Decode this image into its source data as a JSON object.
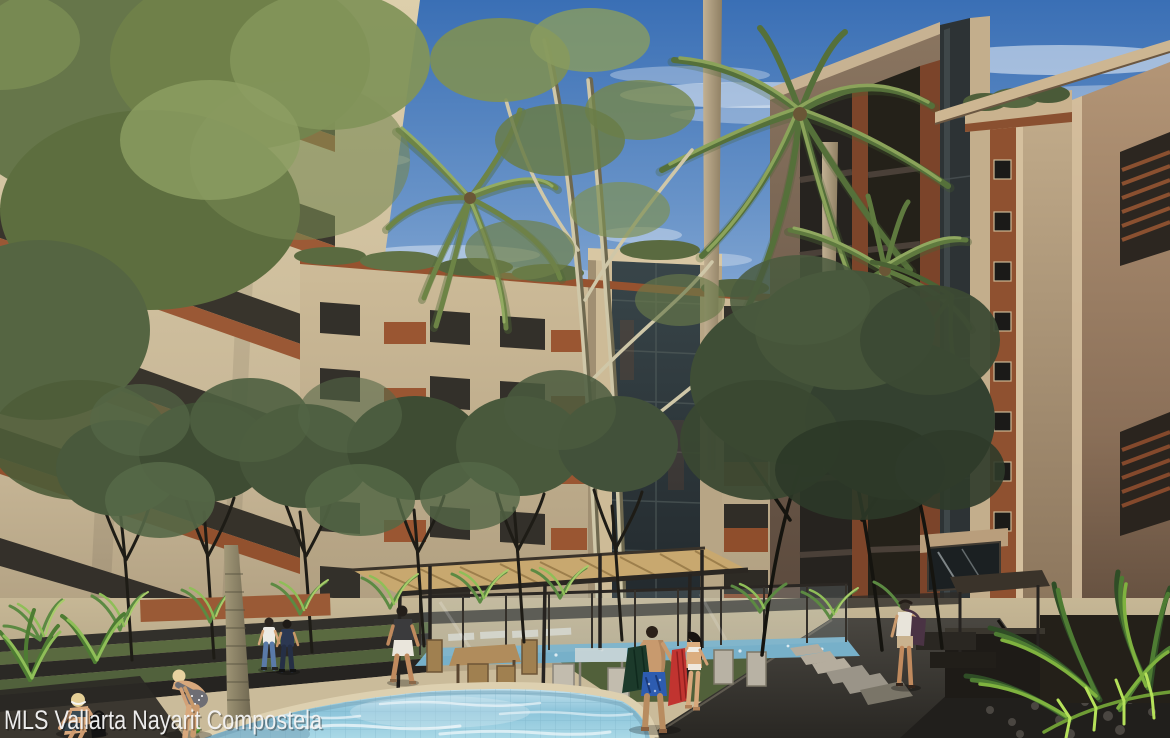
{
  "image": {
    "type": "architectural-rendering",
    "description": "Courtyard pool of a beige residential condo complex with brick balconies, palm trees, pergola, loungers and people",
    "width_px": 1170,
    "height_px": 738
  },
  "watermark": {
    "text": "MLS Vallarta Nayarit Compostela",
    "color": "#f4f4f4",
    "position": "bottom-left"
  },
  "palette": {
    "sky_top": "#3a6fb5",
    "sky_horizon": "#c8d8ea",
    "cloud": "#ffffff",
    "wall_cream": "#d8c9a6",
    "wall_tan": "#b39576",
    "wall_shadow": "#5f4d3e",
    "brick": "#9a5a36",
    "glass_dark": "#2d3335",
    "foliage_light": "#8ba35a",
    "foliage_mid": "#6f8049",
    "foliage_dark": "#3f4e36",
    "fern_bright": "#a8d94f",
    "pool_water": "#9fd0e2",
    "pool_coping": "#ddd0b0",
    "deck_sand": "#cabb9a",
    "path_dark": "#3f3c38",
    "pergola_canopy": "#c8a86f",
    "pergola_frame": "#2b2722",
    "towel_green": "#1c3a2b",
    "towel_red": "#c13430",
    "swim_trunks_blue": "#2d5cb0"
  },
  "scene": {
    "buildings": [
      "left-condo-wing",
      "back-condo-wing",
      "right-condo-tower"
    ],
    "vegetation": [
      "palm-trees",
      "courtyard-trees",
      "ferns",
      "rooftop-planters"
    ],
    "amenities": [
      "round-pool",
      "upper-pool",
      "pergola",
      "dining-tables",
      "sun-loungers",
      "glass-pool-fence",
      "stone-path"
    ],
    "people_count": 9,
    "people": [
      "sitting-woman-poolside",
      "bending-woman-poolside",
      "walking-couple",
      "man-walking-deck",
      "man-with-green-towel",
      "woman-with-red-towel",
      "woman-with-shoulder-bag"
    ]
  }
}
